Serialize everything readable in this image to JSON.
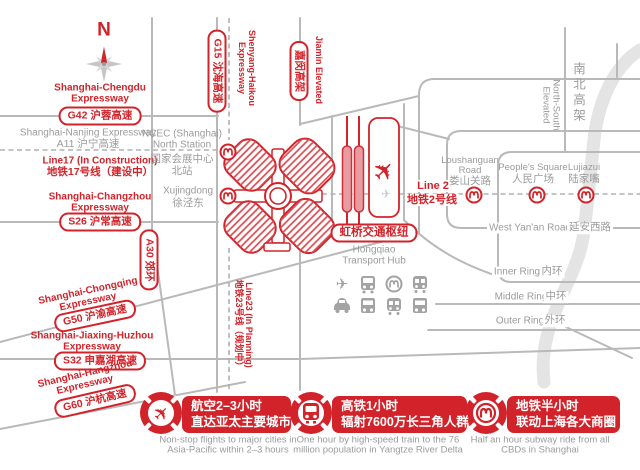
{
  "colors": {
    "accent_red": "#d2232a",
    "gray_text": "#9b9b9b",
    "road_gray": "#b9b9b9",
    "river_gray": "#e4e4e4"
  },
  "compass": {
    "north_label": "N"
  },
  "expressways": {
    "chengdu": {
      "en1": "Shanghai-Chengdu",
      "en2": "Expressway",
      "badge": "G42 沪蓉高速"
    },
    "nanjing": {
      "en": "Shanghai-Nanjing Expressway",
      "zh": "A11 沪宁高速"
    },
    "line17": {
      "en": "Line17 (In Construction)",
      "zh": "地铁17号线（建设中）"
    },
    "changzhou": {
      "en1": "Shanghai-Changzhou",
      "en2": "Expressway",
      "badge": "S26 沪常高速"
    },
    "a30": {
      "badge": "A30 郊环"
    },
    "chongqing": {
      "en1": "Shanghai-Chongqing",
      "en2": "Expressway",
      "badge": "G50 沪渝高速"
    },
    "jiaxinghuzhou": {
      "en1": "Shanghai-Jiaxing-Huzhou",
      "en2": "Expressway",
      "badge": "S32 申嘉湖高速"
    },
    "hangzhou": {
      "en1": "Shanghai-Hangzhou",
      "en2": "Expressway",
      "badge": "G60 沪杭高速"
    },
    "g15": {
      "badge": "G15 沈海高速",
      "en1": "Shenyang-Haikou",
      "en2": "Expressway"
    },
    "jiamin": {
      "badge": "嘉闵高架",
      "en": "Jiamin Elevated"
    },
    "ns_elevated": {
      "en1": "North-South",
      "en2": "Elevated",
      "zh": "南北高架"
    }
  },
  "metro": {
    "line2": {
      "en": "Line 2",
      "zh": "地铁2号线"
    },
    "line23": {
      "en": "Line23 (In Planning)",
      "zh": "地铁23号线（规划中）"
    },
    "stations": {
      "ncec": {
        "en1": "NCEC (Shanghai)",
        "en2": "North Station",
        "zh1": "国家会展中心",
        "zh2": "北站"
      },
      "xujingdong": {
        "en": "Xujingdong",
        "zh": "徐泾东"
      },
      "loushanguan": {
        "en1": "Loushanguan",
        "en2": "Road",
        "zh": "娄山关路"
      },
      "peoples_square": {
        "en": "People's Square",
        "zh": "人民广场"
      },
      "lujiazui": {
        "en": "Lujiazui",
        "zh": "陆家嘴"
      }
    }
  },
  "hub": {
    "badge": "虹桥交通枢纽",
    "en1": "Hongqiao",
    "en2": "Transport Hub"
  },
  "roads": {
    "yanan": {
      "en": "West Yan'an Road",
      "zh": "延安西路"
    },
    "inner_ring": {
      "en": "Inner Ring",
      "zh": "内环"
    },
    "middle_ring": {
      "en": "Middle Ring",
      "zh": "中环"
    },
    "outer_ring": {
      "en": "Outer Ring",
      "zh": "外环"
    }
  },
  "footer": {
    "items": [
      {
        "icon": "flight-ring-icon",
        "title_zh1": "航空2–3小时",
        "title_zh2": "直达亚太主要城市",
        "caption1": "Non-stop flights to major cities in",
        "caption2": "Asia-Pacific within 2–3 hours"
      },
      {
        "icon": "hsr-ring-icon",
        "title_zh1": "高铁1小时",
        "title_zh2": "辐射7600万长三角人群",
        "caption1": "One hour by high-speed train to the 76",
        "caption2": "million population in Yangtze River Delta"
      },
      {
        "icon": "metro-ring-icon",
        "title_zh1": "地铁半小时",
        "title_zh2": "联动上海各大商圈",
        "caption1": "Half an hour subway ride from all",
        "caption2": "CBDs in Shanghai"
      }
    ]
  }
}
